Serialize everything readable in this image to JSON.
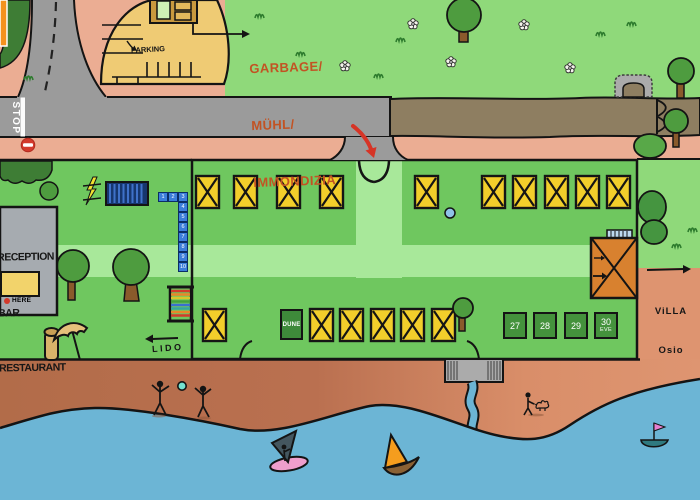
{
  "scene": {
    "description": "hand-drawn campsite / lido map",
    "colors": {
      "grass": "#8FD97A",
      "camp_green": "#6FC75F",
      "path_green": "#A8E89A",
      "hedge_green": "#3E7D35",
      "road_gray": "#9B9B9B",
      "pink_road": "#EBAD93",
      "sand_left": "#B26C49",
      "sand_right": "#DE9571",
      "water_blue": "#6CB5D5",
      "pitch_yellow": "#F2CE2B",
      "pitch_green": "#44923C",
      "tile_blue": "#3C7EDA",
      "building_gray": "#A6ABB0",
      "building_orange": "#D8812F",
      "parking_tan": "#EFCB74",
      "dirt_band": "#8E7E61",
      "arrow_red": "#D63426",
      "note_orange": "#C25323"
    },
    "labels": {
      "stop": "STOP",
      "parking": "PARKING",
      "garbage": [
        "GARBAGE/",
        "MÜHL/",
        "IMMONDIZIA"
      ],
      "reception": [
        "RECEPTION",
        "BAR",
        "RESTAURANT"
      ],
      "here": "HERE",
      "lido": "LIDO",
      "dune": "DUNE",
      "villa": [
        "ViLLA",
        "Osio"
      ],
      "eve": "EVE"
    },
    "numbered_pitches": [
      "27",
      "28",
      "29",
      "30"
    ],
    "blue_tiles": [
      "1",
      "2",
      "3",
      "4",
      "5",
      "6",
      "7",
      "8",
      "9",
      "10"
    ]
  }
}
